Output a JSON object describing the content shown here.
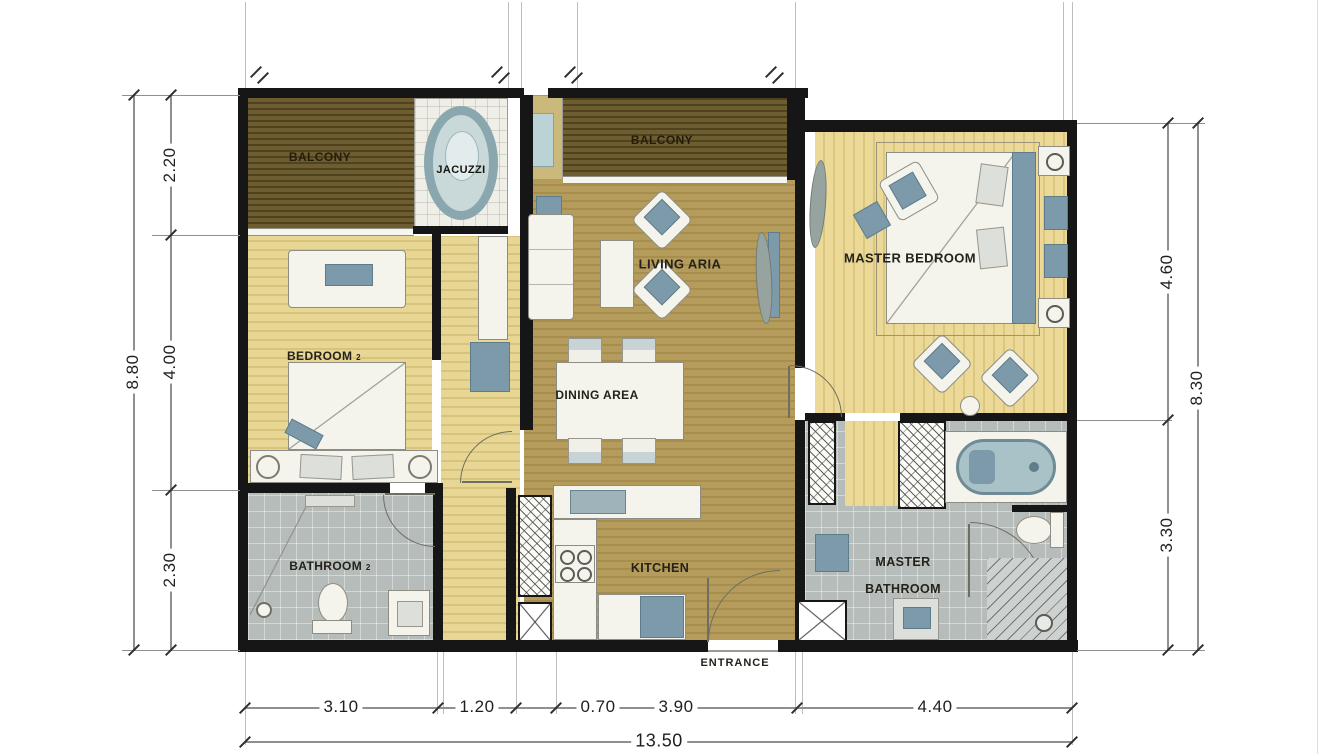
{
  "rooms": {
    "balcony_left": {
      "label": "BALCONY"
    },
    "jacuzzi": {
      "label": "JACUZZI"
    },
    "balcony_top": {
      "label": "BALCONY"
    },
    "living_area": {
      "label": "LIVING ARIA"
    },
    "master_bedroom": {
      "label": "MASTER BEDROOM"
    },
    "bedroom2": {
      "label": "BEDROOM",
      "number": "2"
    },
    "dining_area": {
      "label": "DINING AREA"
    },
    "bathroom2": {
      "label": "BATHROOM",
      "number": "2"
    },
    "kitchen": {
      "label": "KITCHEN"
    },
    "master_bathroom": {
      "line1": "MASTER",
      "line2": "BATHROOM"
    },
    "entrance": {
      "label": "ENTRANCE"
    }
  },
  "dimensions": {
    "left": {
      "overall": "8.80",
      "segments": [
        "2.20",
        "4.00",
        "2.30"
      ]
    },
    "right": {
      "overall": "8.30",
      "segments": [
        "4.60",
        "3.30"
      ]
    },
    "bottom": {
      "overall": "13.50",
      "segments": [
        "3.10",
        "1.20",
        "0.70",
        "3.90",
        "4.40"
      ]
    }
  },
  "colors": {
    "wall": "#161616",
    "balcony_wood": "#6e5d30",
    "bedroom_wood": "#e8d694",
    "living_wood": "#b59c5c",
    "bathroom_tile": "#b6bcba",
    "furniture_accent": "#7d9aaa",
    "dimension_line": "#8f8f8f",
    "dimension_text": "#1f1f1f"
  }
}
